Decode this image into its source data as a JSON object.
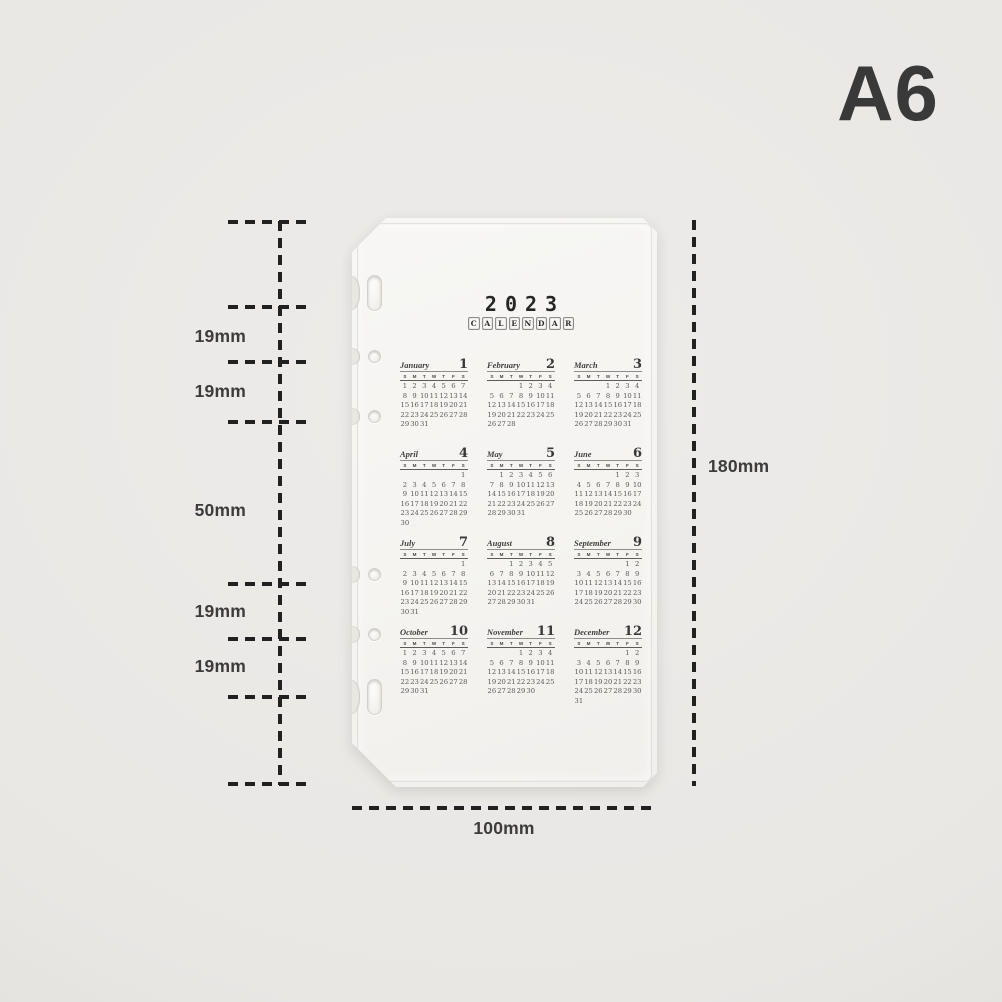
{
  "page": {
    "size_label": "A6",
    "background_color": "#e9e7e4",
    "vignette_color": "#d8d5d1"
  },
  "sheet": {
    "color": "#f5f4f1",
    "year": "2023",
    "calendar_title": "CALENDAR",
    "dow": [
      "S",
      "M",
      "T",
      "W",
      "T",
      "F",
      "S"
    ],
    "months": [
      {
        "name": "January",
        "num": "1",
        "start": 0,
        "days": 31
      },
      {
        "name": "February",
        "num": "2",
        "start": 3,
        "days": 28
      },
      {
        "name": "March",
        "num": "3",
        "start": 3,
        "days": 31
      },
      {
        "name": "April",
        "num": "4",
        "start": 6,
        "days": 30
      },
      {
        "name": "May",
        "num": "5",
        "start": 1,
        "days": 31
      },
      {
        "name": "June",
        "num": "6",
        "start": 4,
        "days": 30
      },
      {
        "name": "July",
        "num": "7",
        "start": 6,
        "days": 31
      },
      {
        "name": "August",
        "num": "8",
        "start": 2,
        "days": 31
      },
      {
        "name": "September",
        "num": "9",
        "start": 5,
        "days": 30
      },
      {
        "name": "October",
        "num": "10",
        "start": 0,
        "days": 31
      },
      {
        "name": "November",
        "num": "11",
        "start": 3,
        "days": 30
      },
      {
        "name": "December",
        "num": "12",
        "start": 5,
        "days": 31
      }
    ]
  },
  "dimensions": {
    "left_segments": [
      "19mm",
      "19mm",
      "50mm",
      "19mm",
      "19mm"
    ],
    "height": "180mm",
    "width": "100mm",
    "ink_color": "#212121",
    "label_color": "#3c3c3c"
  }
}
